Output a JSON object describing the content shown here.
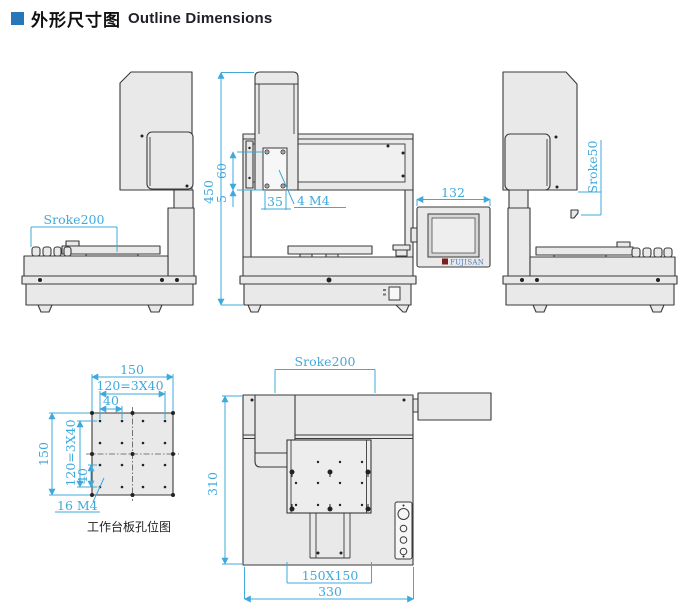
{
  "header": {
    "title_zh": "外形尺寸图",
    "title_en": "Outline Dimensions"
  },
  "colors": {
    "dimension": "#3fa9dc",
    "bullet": "#2777b8",
    "logo_text": "#4a7fc1",
    "logo_mark": "#7d1f1f"
  },
  "left_view": {
    "stroke": "Sroke200",
    "height": "450"
  },
  "front_view": {
    "hole_span": "60",
    "edge_gap": "5",
    "hole_pitch": "35",
    "hole_callout": "4  M4"
  },
  "pendant": {
    "width": "132",
    "logo": "FUJISAN"
  },
  "right_view": {
    "z_stroke": "Sroke50"
  },
  "plate": {
    "width": "150",
    "pitch_total": "120=3X40",
    "pitch": "40",
    "height": "150",
    "v_pitch_total": "120=3X40",
    "v_pitch": "40",
    "hole_callout": "16  M4",
    "caption": "工作台板孔位图"
  },
  "top_view": {
    "stroke": "Sroke200",
    "depth": "310",
    "table_size": "150X150",
    "width": "330"
  }
}
